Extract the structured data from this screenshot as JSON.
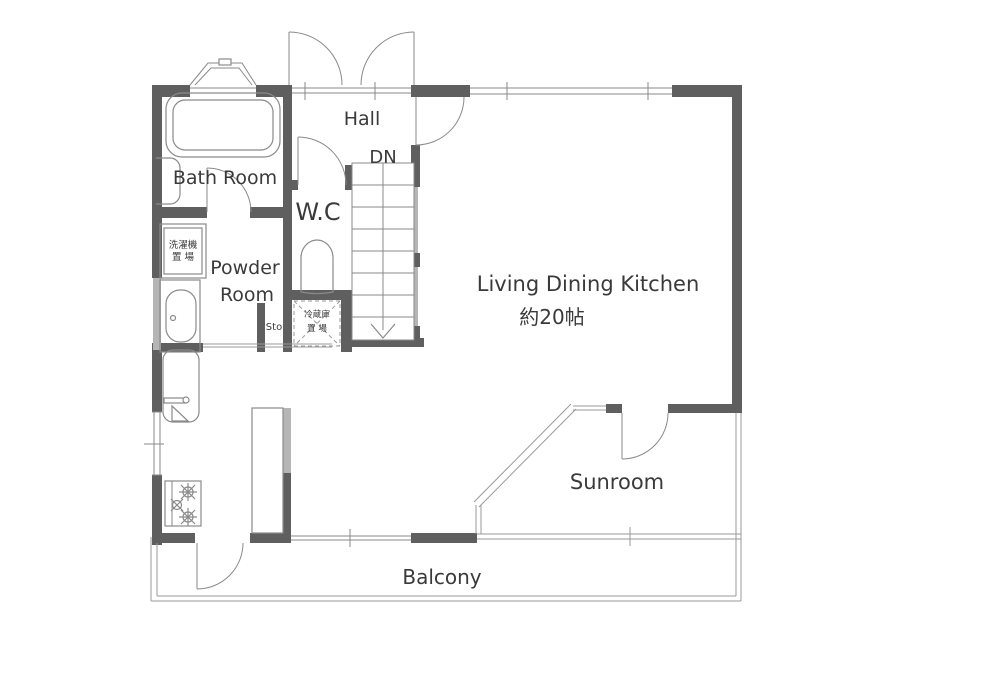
{
  "plan": {
    "labels": {
      "bath": "Bath Room",
      "hall": "Hall",
      "down": "DN",
      "wc": "W.C",
      "powder1": "Powder",
      "powder2": "Room",
      "washing1": "洗濯機",
      "washing2": "置 場",
      "storage": "Sto",
      "fridge1": "冷蔵庫",
      "fridge2": "置 場",
      "ldk1": "Living Dining Kitchen",
      "ldk2": "約20帖",
      "sunroom": "Sunroom",
      "balcony": "Balcony"
    },
    "colors": {
      "wall": "#5f5f5f",
      "wall_light": "#b5b5b5",
      "line": "#8a8a8a",
      "glass": "#9a9a9a",
      "text": "#3a3a3a",
      "background": "#ffffff"
    }
  }
}
